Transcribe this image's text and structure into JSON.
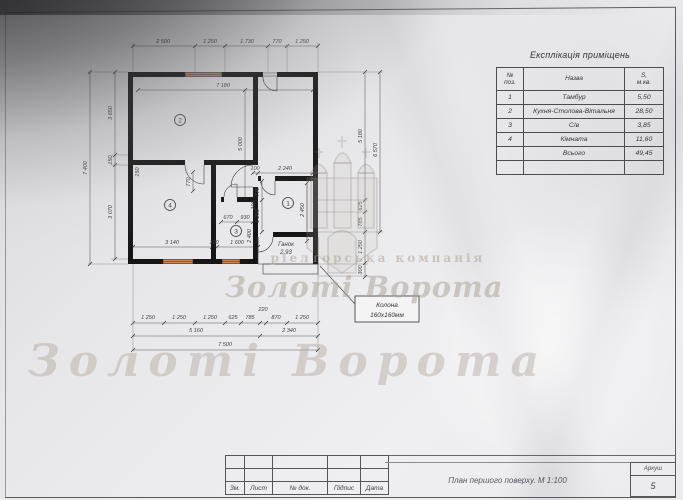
{
  "explication": {
    "title": "Експлікація приміщень",
    "headers": {
      "num": "№\nпоз.",
      "name": "Назва",
      "area": "S,\nм.кв."
    },
    "rows": [
      {
        "num": "1",
        "name": "Тамбур",
        "area": "5,50"
      },
      {
        "num": "2",
        "name": "Кухня-Столова-Вітальня",
        "area": "28,50"
      },
      {
        "num": "3",
        "name": "С/в",
        "area": "3,85"
      },
      {
        "num": "4",
        "name": "Кімната",
        "area": "11,60"
      },
      {
        "num": "",
        "name": "Всього",
        "area": "49,45"
      },
      {
        "num": "",
        "name": "",
        "area": ""
      }
    ]
  },
  "title_block": {
    "cols": [
      "Зм.",
      "Лист",
      "№ док.",
      "Підпис",
      "Дата"
    ],
    "drawing_title": "План першого поверху. М 1:100",
    "sheet_label": "Аркуш",
    "sheet_number": "5"
  },
  "callout": {
    "line1": "Колона",
    "line2": "160х160мм"
  },
  "watermark": {
    "band": "ріелторська компанія",
    "big": "Золоті Ворота"
  },
  "plan": {
    "rooms": {
      "r1": "1",
      "r2": "2",
      "r3": "3",
      "r4": "4"
    },
    "porch": {
      "name": "Ганок",
      "area": "2,93"
    },
    "colors": {
      "wall": "#161616",
      "window": "#cd8257"
    },
    "dims": [
      {
        "t": "2 500",
        "x": 108,
        "y": 23
      },
      {
        "t": "1 250",
        "x": 155,
        "y": 23
      },
      {
        "t": "1 730",
        "x": 192,
        "y": 23
      },
      {
        "t": "770",
        "x": 222,
        "y": 23
      },
      {
        "t": "1 250",
        "x": 247,
        "y": 23
      },
      {
        "t": "7 180",
        "x": 168,
        "y": 67
      },
      {
        "t": "7 400",
        "x": 32,
        "y": 148,
        "r": -90
      },
      {
        "t": "3 650",
        "x": 57,
        "y": 93,
        "r": -90
      },
      {
        "t": "150",
        "x": 57,
        "y": 140,
        "r": -90
      },
      {
        "t": "3 070",
        "x": 57,
        "y": 192,
        "r": -90
      },
      {
        "t": "5 000",
        "x": 187,
        "y": 124,
        "r": -90
      },
      {
        "t": "5 180",
        "x": 307,
        "y": 116,
        "r": -90
      },
      {
        "t": "625",
        "x": 307,
        "y": 186,
        "r": -90
      },
      {
        "t": "785",
        "x": 307,
        "y": 202,
        "r": -90
      },
      {
        "t": "1 250",
        "x": 307,
        "y": 227,
        "r": -90
      },
      {
        "t": "300",
        "x": 307,
        "y": 250,
        "r": -90
      },
      {
        "t": "6 570",
        "x": 322,
        "y": 130,
        "r": -90
      },
      {
        "t": "100",
        "x": 200,
        "y": 150
      },
      {
        "t": "2 240",
        "x": 230,
        "y": 150
      },
      {
        "t": "770",
        "x": 204,
        "y": 172,
        "r": -90
      },
      {
        "t": "1 250",
        "x": 204,
        "y": 196,
        "r": -90
      },
      {
        "t": "2 450",
        "x": 249,
        "y": 190,
        "r": -90
      },
      {
        "t": "770",
        "x": 135,
        "y": 162,
        "r": -90
      },
      {
        "t": "150",
        "x": 84,
        "y": 152,
        "r": -90
      },
      {
        "t": "670",
        "x": 173,
        "y": 199
      },
      {
        "t": "930",
        "x": 190,
        "y": 199
      },
      {
        "t": "100",
        "x": 200,
        "y": 185,
        "r": -90
      },
      {
        "t": "2 400",
        "x": 196,
        "y": 216,
        "r": -90
      },
      {
        "t": "3 140",
        "x": 117,
        "y": 224
      },
      {
        "t": "100",
        "x": 159,
        "y": 224
      },
      {
        "t": "1 600",
        "x": 182,
        "y": 224
      },
      {
        "t": "1 250",
        "x": 93,
        "y": 299
      },
      {
        "t": "1 250",
        "x": 124,
        "y": 299
      },
      {
        "t": "1 250",
        "x": 155,
        "y": 299
      },
      {
        "t": "625",
        "x": 178,
        "y": 299
      },
      {
        "t": "785",
        "x": 195,
        "y": 299
      },
      {
        "t": "220",
        "x": 208,
        "y": 291
      },
      {
        "t": "870",
        "x": 221,
        "y": 299
      },
      {
        "t": "1 250",
        "x": 247,
        "y": 299
      },
      {
        "t": "5 160",
        "x": 141,
        "y": 312
      },
      {
        "t": "2 340",
        "x": 234,
        "y": 312
      },
      {
        "t": "7 500",
        "x": 170,
        "y": 326
      }
    ]
  }
}
